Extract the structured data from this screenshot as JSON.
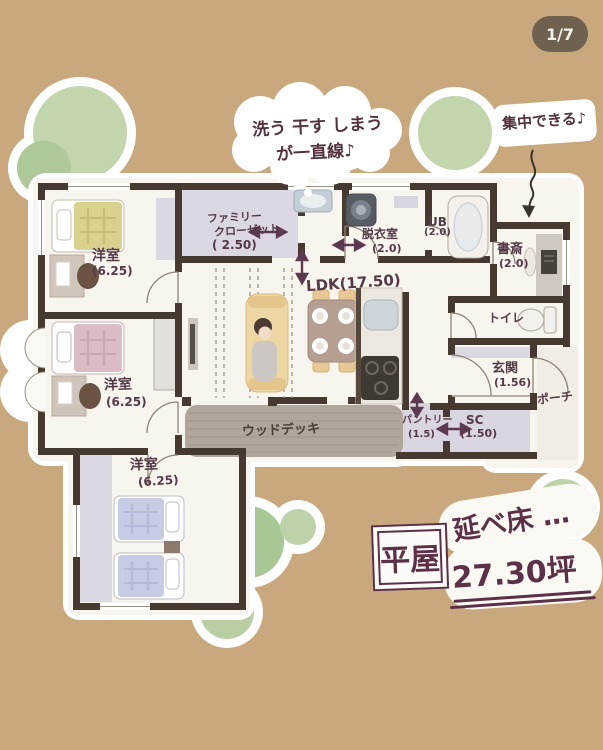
{
  "page": {
    "badge": "1/7"
  },
  "annotations": {
    "laundry_bubble": {
      "line1": "洗う 干す しまう",
      "line2": "が一直線♪"
    },
    "study_bubble": {
      "text": "集中できる♪"
    }
  },
  "rooms": {
    "bedroom_top": {
      "name": "洋室",
      "area": "(6.25)"
    },
    "family_closet": {
      "line1": "ファミリー",
      "line2": "クローゼット",
      "area": "( 2.50)"
    },
    "dressing_room": {
      "name": "脱衣室",
      "area": "(2.0)"
    },
    "unit_bath": {
      "name": "UB",
      "area": "(2.0)"
    },
    "study": {
      "name": "書斎",
      "area": "(2.0)"
    },
    "ldk": {
      "name": "LDK(17.50)"
    },
    "toilet": {
      "name": "トイレ"
    },
    "bedroom_middle": {
      "name": "洋室",
      "area": "(6.25)"
    },
    "entrance": {
      "name": "玄関",
      "area": "(1.56)"
    },
    "porch": {
      "name": "ポーチ"
    },
    "wood_deck": {
      "name": "ウッドデッキ"
    },
    "pantry": {
      "name": "パントリー",
      "area": "(1.5)"
    },
    "shoe_closet": {
      "name": "SC",
      "area": "(1.50)"
    },
    "bedroom_bottom": {
      "name": "洋室",
      "area": "(6.25)"
    }
  },
  "summary": {
    "house_type": "平屋",
    "label": "延べ床 …",
    "value": "27.30坪"
  },
  "colors": {
    "background": "#c9a87d",
    "wall": "#463a30",
    "paper": "#f8f5ef",
    "handwriting": "#533a46",
    "accent": "#5c3148",
    "tree_green": "#b9cfa3",
    "deck": "#b1a69b",
    "closet_fill": "#dbd7e3",
    "badge_bg": "#6f6150",
    "bed_yellow": "#d8d28e",
    "bed_pink": "#d9bcc4",
    "bed_blue": "#c7cce4"
  }
}
